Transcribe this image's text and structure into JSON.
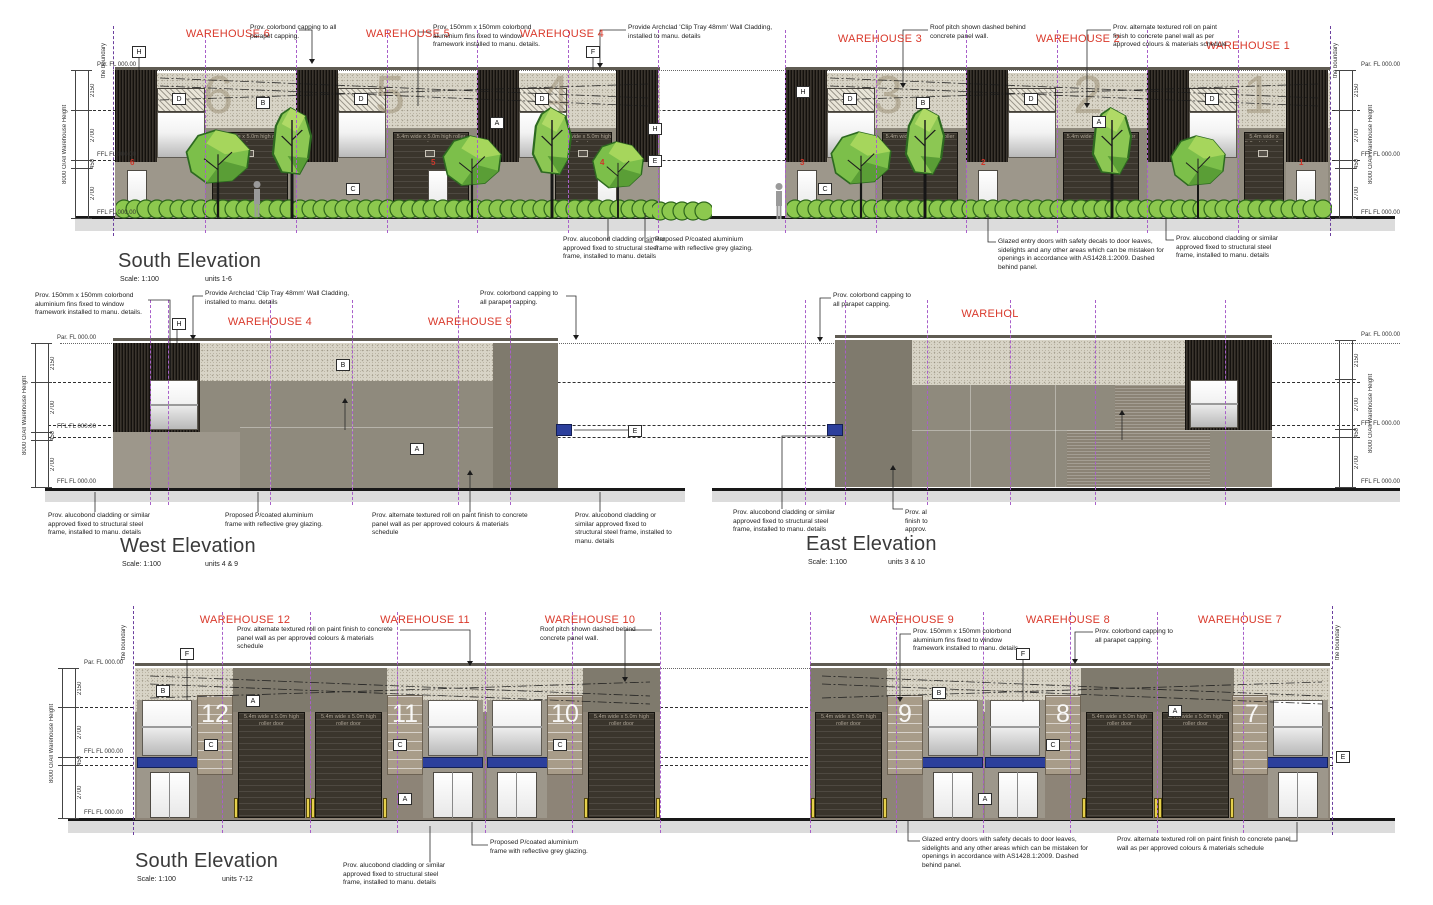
{
  "colors": {
    "label_red": "#d9392b",
    "grid_purple": "#a85fc9",
    "canopy_blue": "#2c3f9c",
    "bollard_yellow": "#e6d04b"
  },
  "boundary_label": "the boundary",
  "roller_door_label": "5.4m wide x 5.0m high roller door",
  "dims": {
    "overall": "8000 O/All Warehouse Height",
    "segments": [
      "2150",
      "2700",
      "450",
      "2700"
    ],
    "parapet_level": "Par. FL 000.00",
    "ffl_level": "FFL FL 000.00"
  },
  "tags": {
    "top": [
      "H",
      "D",
      "B",
      "D",
      "A",
      "D",
      "F",
      "H",
      "E",
      "H",
      "D",
      "B",
      "D",
      "A",
      "D",
      "C",
      "C"
    ],
    "west": [
      "H",
      "B",
      "A",
      "E"
    ],
    "bottom_left": [
      "F",
      "B",
      "A",
      "C",
      "C",
      "C",
      "A"
    ],
    "bottom_right": [
      "F",
      "B",
      "A",
      "C",
      "A",
      "E"
    ]
  },
  "notes": {
    "capping": "Prov. colorbond capping to all parapet capping.",
    "fins": "Prov. 150mm x 150mm colorbond aluminium fins fixed to window framework installed to manu. details.",
    "archclad": "Provide Archclad 'Clip Tray 48mm' Wall Cladding, installed to manu. details",
    "roof_pitch": "Roof pitch shown dashed behind concrete panel wall.",
    "textured": "Prov. alternate textured roll on paint finish to concrete panel wall as per approved colours & materials schedule",
    "alucobond": "Prov. alucobond cladding or similar approved fixed to structural steel frame, installed to manu. details",
    "pcoated": "Proposed P/coated aluminium frame with reflective grey glazing.",
    "glazed": "Glazed entry doors with safety decals to door leaves, sidelights and any other areas which can be mistaken for openings in accordance with AS1428.1:2009. Dashed behind panel.",
    "textured_clipped": "Prov. al\nfinish to\napprov."
  },
  "elevations": {
    "south_1_6": {
      "title": "South Elevation",
      "scale": "Scale: 1:100",
      "units": "units 1-6",
      "warehouses": [
        "WAREHOUSE 6",
        "WAREHOUSE 5",
        "WAREHOUSE 4",
        "WAREHOUSE 3",
        "WAREHOUSE 2",
        "WAREHOUSE 1"
      ],
      "unit_numbers": [
        "6",
        "5",
        "4",
        "3",
        "2",
        "1"
      ]
    },
    "west": {
      "title": "West Elevation",
      "scale": "Scale: 1:100",
      "units": "units 4 & 9",
      "warehouses": [
        "WAREHOUSE 4",
        "WAREHOUSE 9"
      ]
    },
    "east": {
      "title": "East Elevation",
      "scale": "Scale: 1:100",
      "units": "units 3 & 10",
      "warehouses": [
        "WAREHOL"
      ]
    },
    "south_7_12": {
      "title": "South Elevation",
      "scale": "Scale: 1:100",
      "units": "units 7-12",
      "warehouses": [
        "WAREHOUSE 12",
        "WAREHOUSE 11",
        "WAREHOUSE 10",
        "WAREHOUSE 9",
        "WAREHOUSE 8",
        "WAREHOUSE 7"
      ],
      "unit_numbers": [
        "12",
        "11",
        "10",
        "9",
        "8",
        "7"
      ]
    }
  }
}
